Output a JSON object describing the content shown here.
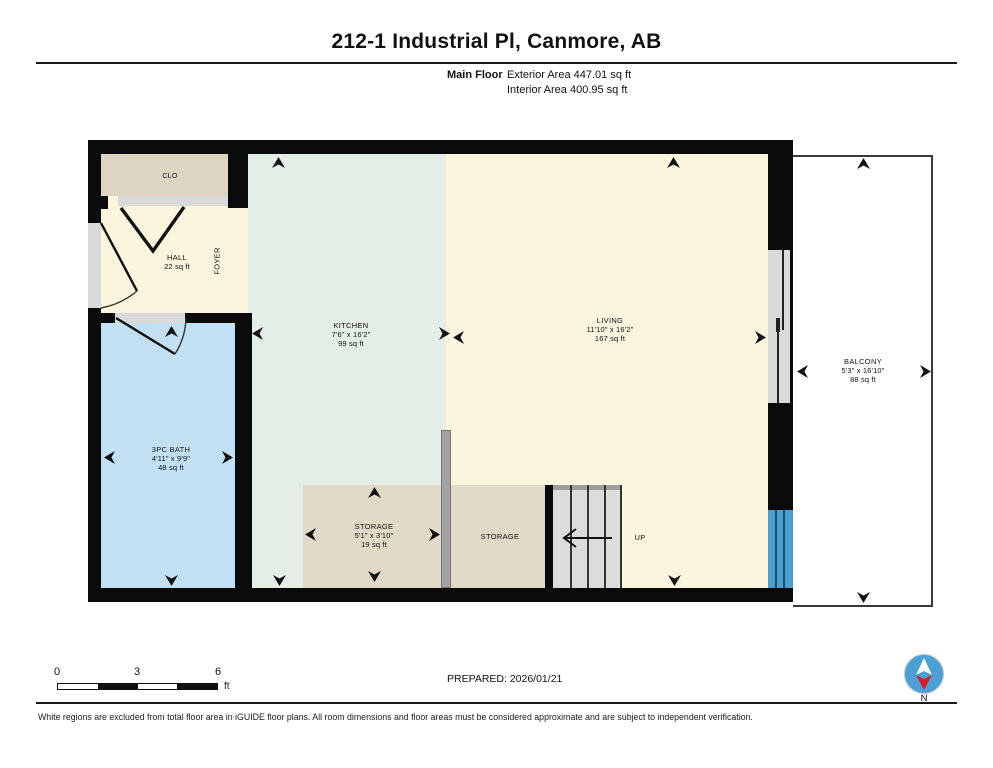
{
  "header": {
    "title": "212-1 Industrial Pl, Canmore, AB",
    "floor_label": "Main Floor",
    "exterior_area": "Exterior Area 447.01 sq ft",
    "interior_area": "Interior Area 400.95 sq ft"
  },
  "rooms": {
    "clo": {
      "name": "CLO"
    },
    "hall": {
      "name": "HALL",
      "area": "22 sq ft"
    },
    "foyer": {
      "name": "FOYER"
    },
    "kitchen": {
      "name": "KITCHEN",
      "dims": "7'6\" x 16'2\"",
      "area": "99 sq ft"
    },
    "living": {
      "name": "LIVING",
      "dims": "11'10\" x 16'2\"",
      "area": "167 sq ft"
    },
    "bath": {
      "name": "3PC BATH",
      "dims": "4'11\" x 9'9\"",
      "area": "48 sq ft"
    },
    "storage1": {
      "name": "STORAGE",
      "dims": "5'1\" x 3'10\"",
      "area": "19 sq ft"
    },
    "storage2": {
      "name": "STORAGE"
    },
    "stairs": {
      "label": "UP"
    },
    "balcony": {
      "name": "BALCONY",
      "dims": "5'3\" x 16'10\"",
      "area": "88 sq ft"
    }
  },
  "footer": {
    "scale_ticks": {
      "t0": "0",
      "t1": "3",
      "t2": "6"
    },
    "scale_unit": "ft",
    "prepared": "PREPARED: 2026/01/21",
    "compass_label": "N",
    "disclaimer": "White regions are excluded from total floor area in iGUIDE floor plans. All room dimensions and floor areas must be considered approximate and are subject to independent verification."
  },
  "colors": {
    "wall": "#0a0a0a",
    "cream": "#faf5dc",
    "kitchen": "#e4ede6",
    "bath": "#c2e0f4",
    "closet": "#ddd5c2",
    "storage": "#e1d9c8",
    "balcony": "#ffffff",
    "window": "#4a9fd0",
    "stair": "#dcdcdc",
    "opening": "#d9d9d9",
    "compass_blue": "#4ba0d6",
    "compass_red": "#d81f26"
  }
}
